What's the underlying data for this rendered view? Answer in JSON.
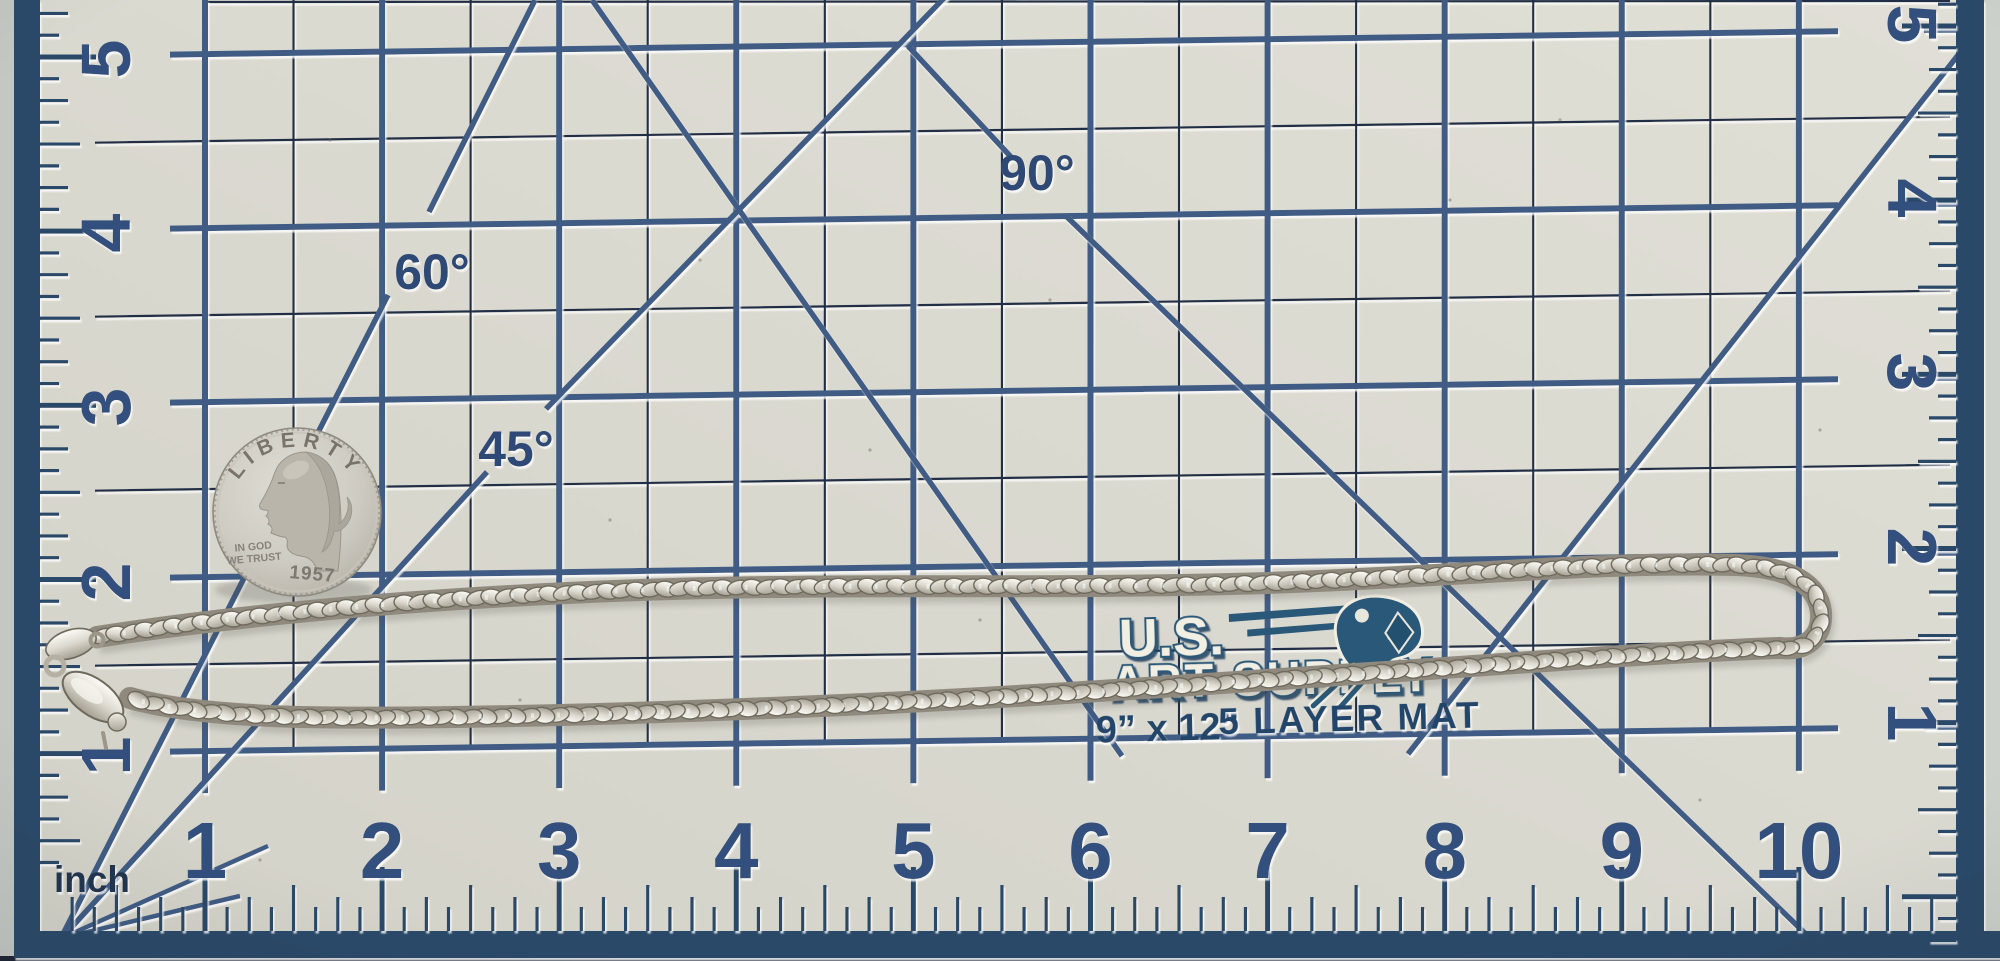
{
  "mat": {
    "unit_label": "inch",
    "bottom_numbers": [
      "1",
      "2",
      "3",
      "4",
      "5",
      "6",
      "7",
      "8",
      "9",
      "10"
    ],
    "left_numbers": [
      "5",
      "4",
      "3",
      "2",
      "1"
    ],
    "right_numbers": [
      "5",
      "4",
      "3",
      "2",
      "1"
    ],
    "angle_labels": {
      "deg60": "60°",
      "deg45": "45°",
      "deg90": "90°"
    },
    "brand": {
      "initials": "U.S.",
      "name": "ART SUPPLY"
    },
    "size_text": "9” x 12”",
    "type_text": "5 LAYER MAT",
    "colors": {
      "surface": "#dad9d0",
      "line_major": "#3f5c84",
      "line_minor": "#202e44",
      "ruler_bar": "#2c4868",
      "numerals": "#31507d",
      "label_text": "#2d4a74",
      "brand_navy": "#2a5878",
      "brand_fill": "#f1eee3"
    }
  },
  "coin": {
    "legend_top": "LIBERTY",
    "motto_line1": "IN GOD",
    "motto_line2": "WE TRUST",
    "date": "1957",
    "colors": {
      "face": "#cfccc3",
      "portrait": "#bab5ab",
      "engraving": "#6f6a61"
    }
  },
  "chain": {
    "colors": {
      "silver_light": "#fdfcf7",
      "silver_mid": "#cdc9be",
      "silver_dark": "#8a8578",
      "outline": "#6f6a5e"
    }
  }
}
